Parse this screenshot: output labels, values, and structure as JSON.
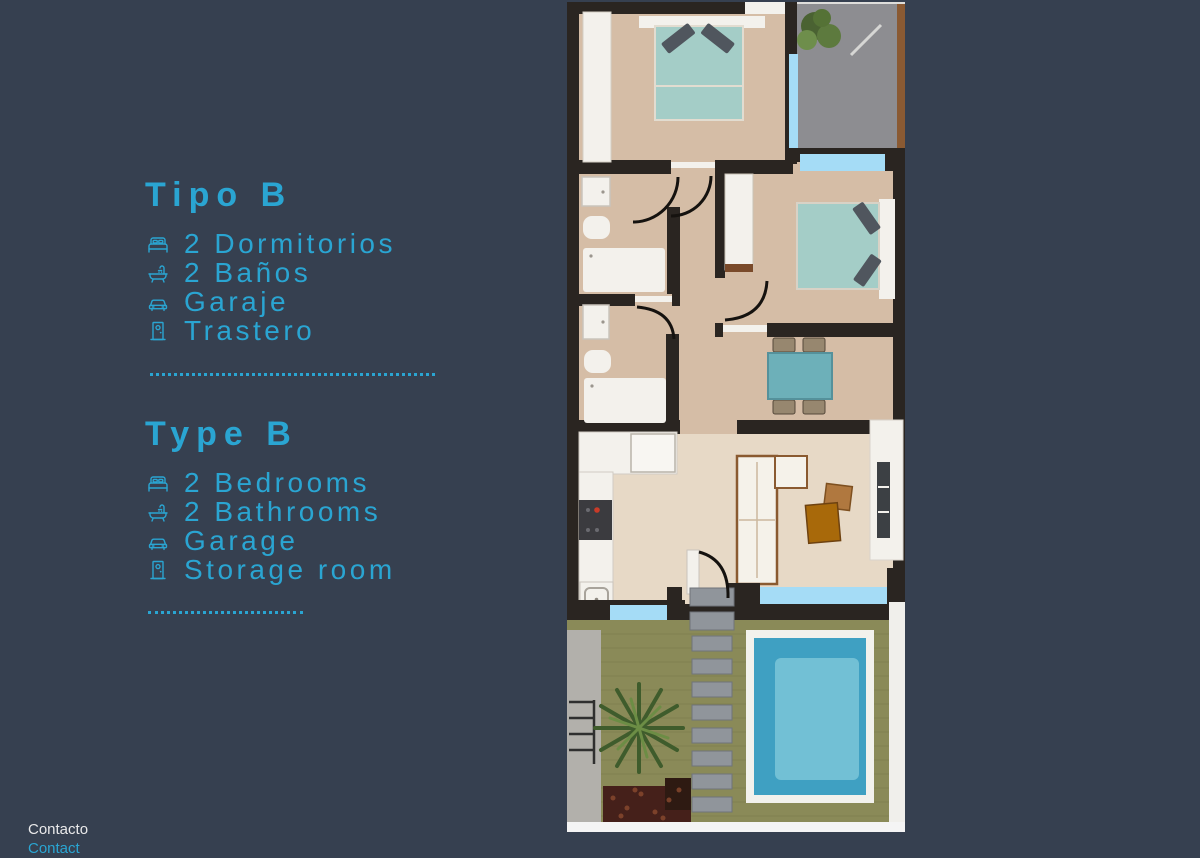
{
  "colors": {
    "background": "#364050",
    "accent": "#2aa5d2",
    "text_light": "#e9e9ea",
    "plan_wall": "#2a2521",
    "plan_line": "#15120f",
    "plan_floor": "#d5bda6",
    "plan_floor_light": "#e7d9c6",
    "plan_white": "#f3f1ec",
    "plan_teal": "#a4cdc7",
    "plan_teal_dark": "#6db0b9",
    "plan_pillow": "#50565e",
    "plan_gray": "#8d8d91",
    "plan_window_blue": "#a5dcf6",
    "plan_fence": "#8a5a33",
    "plan_wood": "#b0783f",
    "plan_green": "#8a8a58",
    "plan_pool": "#3fa0c2",
    "plan_pool_light": "#7bc6d8",
    "plan_path": "#b2b0ab",
    "plan_stone": "#90959b",
    "plan_plant": "#3f5c2c",
    "plan_plant_light": "#6c8d45",
    "plan_mulch": "#45201a"
  },
  "sections": [
    {
      "title": "Tipo B",
      "items": [
        {
          "icon": "bed-icon",
          "label": "2 Dormitorios"
        },
        {
          "icon": "bath-icon",
          "label": "2 Baños"
        },
        {
          "icon": "car-icon",
          "label": "Garaje"
        },
        {
          "icon": "door-icon",
          "label": "Trastero"
        }
      ]
    },
    {
      "title": "Type B",
      "items": [
        {
          "icon": "bed-icon",
          "label": "2 Bedrooms"
        },
        {
          "icon": "bath-icon",
          "label": "2 Bathrooms"
        },
        {
          "icon": "car-icon",
          "label": "Garage"
        },
        {
          "icon": "door-icon",
          "label": "Storage room"
        }
      ]
    }
  ],
  "footer": {
    "primary": "Contacto",
    "secondary": "Contact"
  }
}
